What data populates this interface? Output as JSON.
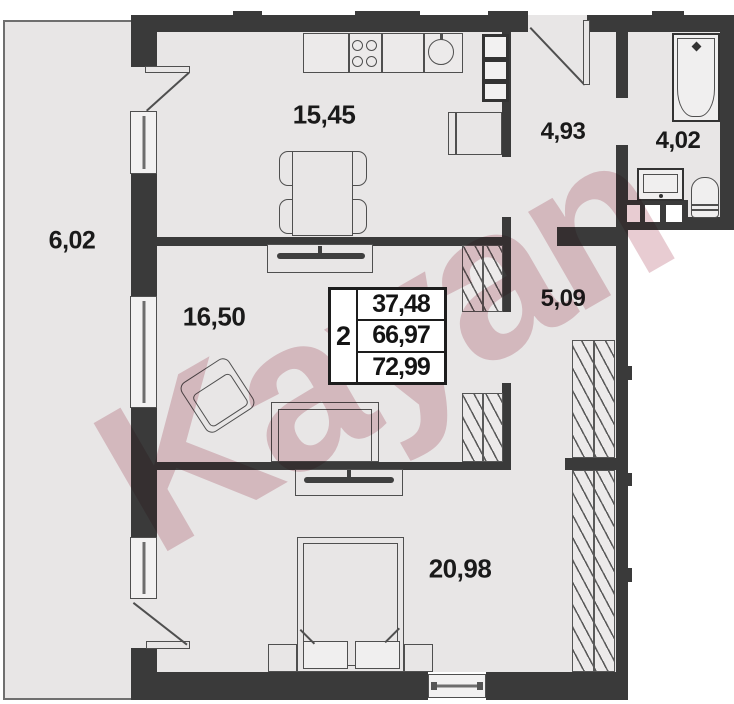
{
  "title": "apartment-floor-plan",
  "watermark": "Kayan",
  "info_box": {
    "rooms_count": "2",
    "area_living": "37,48",
    "area_main": "66,97",
    "area_total": "72,99"
  },
  "rooms": {
    "kitchen": "15,45",
    "entry_hall": "4,93",
    "bathroom": "4,02",
    "balcony": "6,02",
    "living": "16,50",
    "inner_hall": "5,09",
    "bedroom": "20,98"
  },
  "colors": {
    "wall": "#3a3a3a",
    "floor": "#e8e6e6",
    "outline": "#4f4f4f",
    "watermark": "#c47e8e"
  }
}
